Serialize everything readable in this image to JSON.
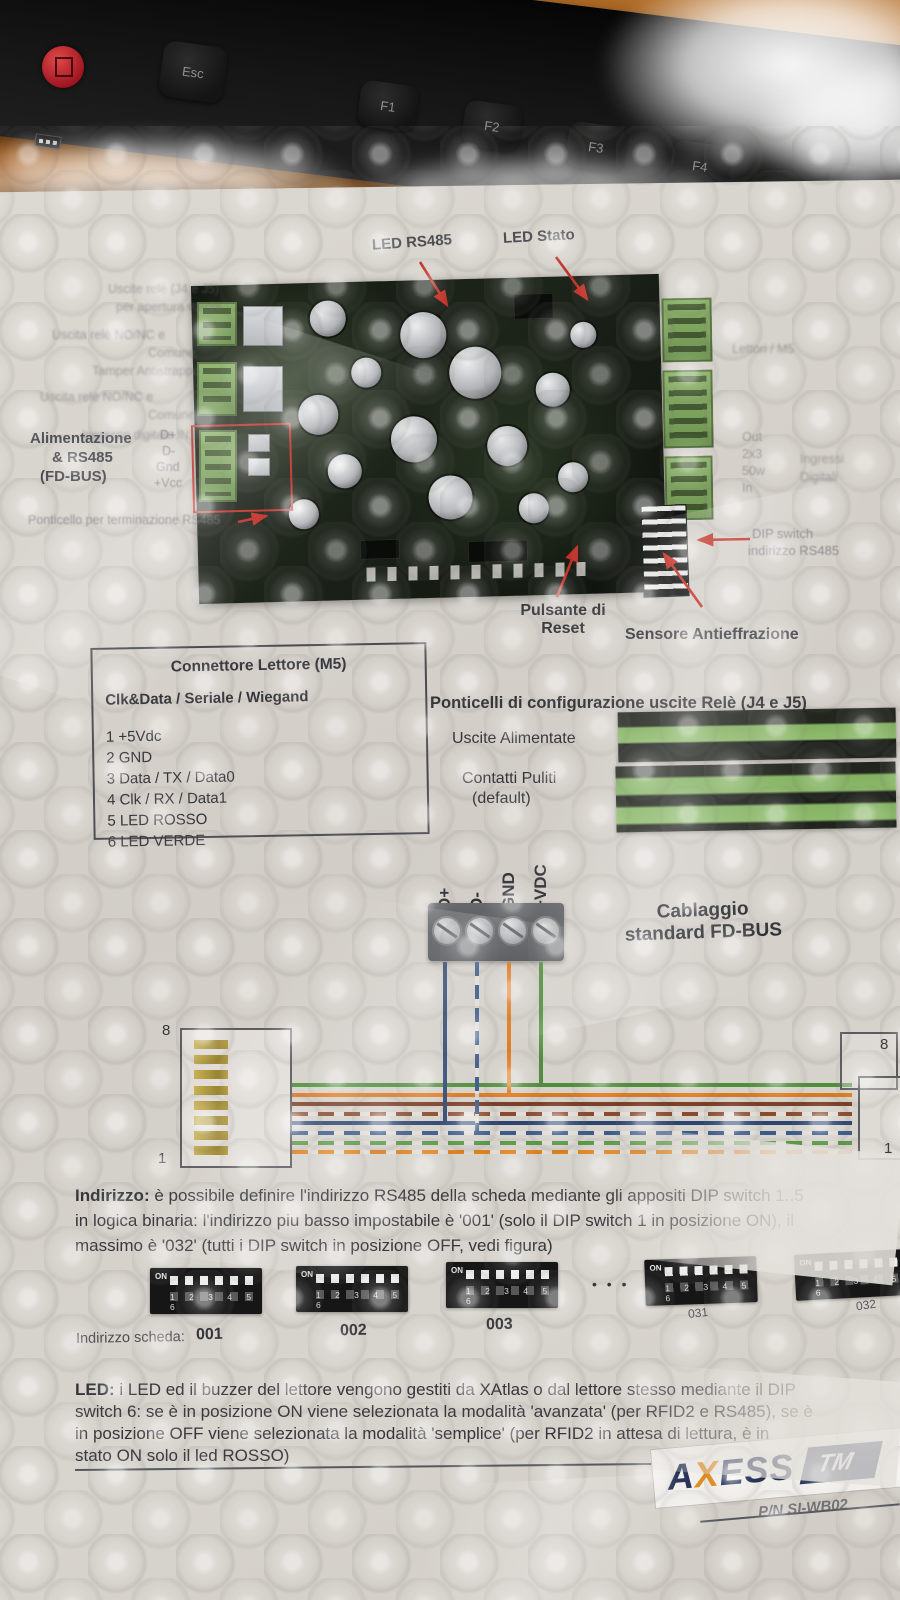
{
  "keyboard": {
    "keys": [
      {
        "label": "Esc"
      },
      {
        "label": "F1"
      },
      {
        "label": "F2"
      },
      {
        "label": "F3"
      },
      {
        "label": "F4"
      },
      {
        "label": "F5"
      }
    ]
  },
  "board": {
    "label_led_rs485": "LED RS485",
    "label_led_stato": "LED Stato",
    "left_small_labels": [
      "Uscite relè (J4 e J5)",
      "per apertura varchi",
      "Uscita relè NO/NC e",
      "Comune",
      "Tamper Antistrappo",
      "Uscita relè NO/NC e",
      "Comune",
      "Ingresso digitale IN1"
    ],
    "right_small_labels": [
      "Lettori / M5",
      "Out",
      "2x3",
      "50w",
      "In",
      "Ingressi",
      "Digitali"
    ],
    "alim_line1": "Alimentazione",
    "alim_line2": "& RS485",
    "alim_line3": "(FD-BUS)",
    "alim_pins": [
      "D+",
      "D-",
      "Gnd",
      "+Vcc"
    ],
    "terminazione_label": "Ponticello per terminazione RS485",
    "dip_label_line1": "DIP switch",
    "dip_label_line2": "indirizzo RS485",
    "reset_label_line1": "Pulsante di",
    "reset_label_line2": "Reset",
    "sensore_label": "Sensore Antieffrazione"
  },
  "connettore": {
    "title": "Connettore Lettore (M5)",
    "subtitle": "Clk&Data / Seriale / Wiegand",
    "pins": [
      "1  +5Vdc",
      "2  GND",
      "3  Data / TX / Data0",
      "4  Clk / RX / Data1",
      "5  LED ROSSO",
      "6  LED VERDE"
    ]
  },
  "ponticelli": {
    "title": "Ponticelli di configurazione uscite Relè (J4 e J5)",
    "uscite_alimentate": "Uscite Alimentate",
    "contatti_puliti": "Contatti Puliti",
    "default_note": "(default)"
  },
  "cablaggio": {
    "terminals": [
      "D+",
      "D-",
      "GND",
      "+VDC"
    ],
    "caption_line1": "Cablaggio",
    "caption_line2": "standard FD-BUS",
    "pin_top": "8",
    "pin_bottom": "1",
    "bundle_colors": [
      {
        "color": "#4f8f3b",
        "dashed": false
      },
      {
        "color": "#e07a1e",
        "dashed": false
      },
      {
        "color": "#7a3a22",
        "dashed": false
      },
      {
        "color": "#8a4a2e",
        "dashed": true
      },
      {
        "color": "#2c4470",
        "dashed": false
      },
      {
        "color": "#3c5a8a",
        "dashed": true
      },
      {
        "color": "#5a9a46",
        "dashed": true
      },
      {
        "color": "#e0821e",
        "dashed": true
      }
    ],
    "drops": [
      {
        "x": 443,
        "row": 4,
        "color": "#2c4470",
        "dashed": false
      },
      {
        "x": 475,
        "row": 5,
        "color": "#3c5a8a",
        "dashed": true
      },
      {
        "x": 507,
        "row": 1,
        "color": "#e07a1e",
        "dashed": false
      },
      {
        "x": 539,
        "row": 0,
        "color": "#4f8f3b",
        "dashed": false
      }
    ]
  },
  "indirizzo": {
    "intro_bold": "Indirizzo:",
    "line1_rest": " è possibile definire l'indirizzo RS485 della scheda mediante gli appositi DIP switch 1..5",
    "line2": "in logica binaria: l'indirizzo piu basso impostabile è '001' (solo il DIP switch 1 in posizione ON), il",
    "line3": "massimo è '032' (tutti i DIP switch in posizione OFF, vedi figura)",
    "ellipsis": "• • •",
    "dip_on_label": "ON",
    "dip_numbers": "1 2 3 4 5 6",
    "scheda_label": "Indirizzo scheda:",
    "addresses": [
      "001",
      "002",
      "003"
    ],
    "addresses_right": [
      "031",
      "032"
    ]
  },
  "led_note": {
    "intro_bold": "LED:",
    "line1_rest": " i LED ed il buzzer del lettore vengono gestiti da XAtlas o dal lettore stesso mediante il DIP",
    "line2": "switch 6: se è in posizione ON viene selezionata la modalità 'avanzata' (per RFID2 e RS485), se è",
    "line3": "in posizione OFF viene selezionata la modalità 'semplice' (per RFID2 in attesa di lettura, è in",
    "line4": "stato ON solo il led ROSSO)"
  },
  "footer": {
    "brand_pre": "A",
    "brand_x": "X",
    "brand_post": "ESS",
    "brand_tag": "TM",
    "part_number": "P/N SI-WB02"
  },
  "colors": {
    "annotation_red": "#c43026",
    "pcb_green_terminal": "#7aa05a",
    "logo_navy": "#1e2a4f",
    "logo_orange": "#e08a1e"
  }
}
